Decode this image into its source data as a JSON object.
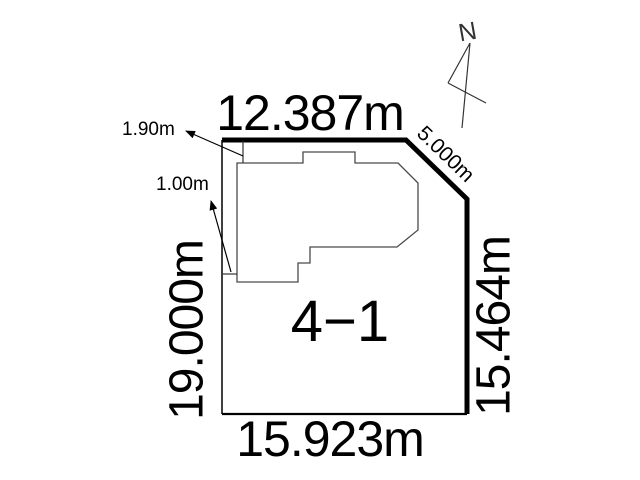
{
  "diagram": {
    "parcel_label": "4−1",
    "dimensions": {
      "top": "12.387m",
      "northeast": "5.000m",
      "right": "15.464m",
      "bottom": "15.923m",
      "left": "19.000m"
    },
    "setbacks": {
      "top_offset": "1.90m",
      "left_offset": "1.00m"
    },
    "compass": {
      "north": "N"
    },
    "colors": {
      "background": "#ffffff",
      "boundary": "#000000",
      "building_outline": "#4a4a4a",
      "text": "#000000",
      "compass_lines": "#333333"
    }
  }
}
